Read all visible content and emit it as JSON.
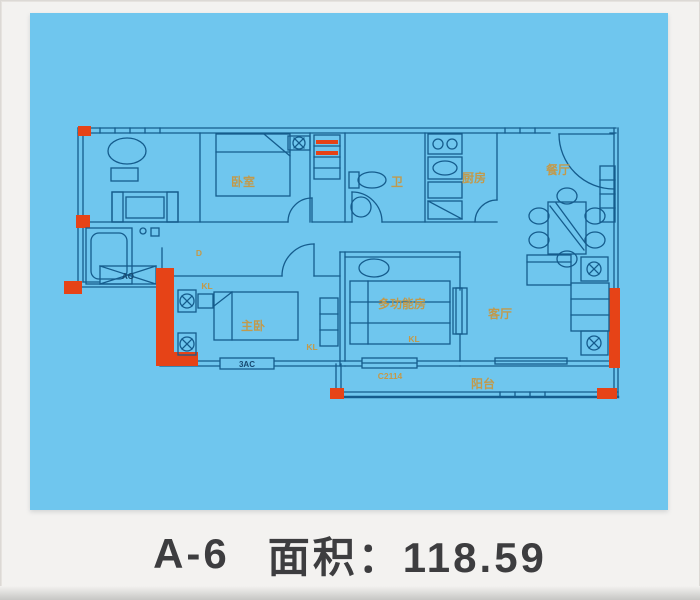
{
  "caption": {
    "unit": "A-6",
    "area": "面积：118.59"
  },
  "floorplan": {
    "rooms": {
      "bedroom": "卧室",
      "bath": "卫",
      "kitchen": "厨房",
      "dining": "餐厅",
      "master": "主卧",
      "multi": "多功能房",
      "living": "客厅",
      "balcony": "阳台"
    },
    "codes": {
      "door_d": "D",
      "kl": "KL",
      "window_ao": "AO",
      "window_3ac": "3AC",
      "window_c2114": "C2114"
    },
    "colors": {
      "canvas": "#6fc6ee",
      "line": "#155c8d",
      "accent": "#e64317",
      "room_label": "#c9973f",
      "code_label": "#16486f",
      "caption_text": "#3d3d3f",
      "page_bg": "#f3f2f0"
    }
  }
}
